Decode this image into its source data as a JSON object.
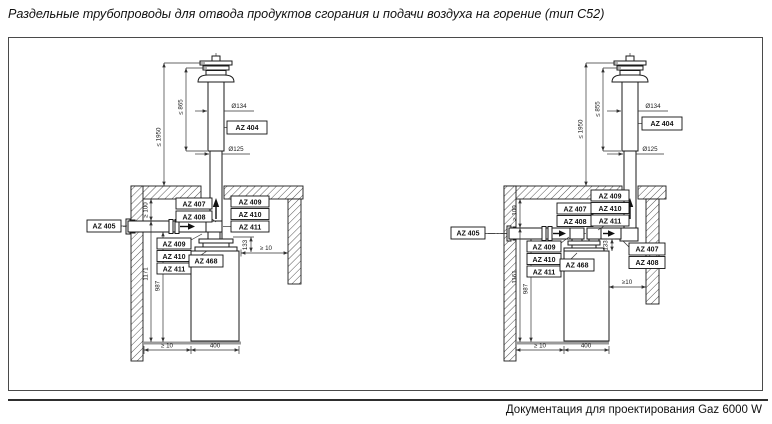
{
  "page": {
    "title": "Раздельные трубопроводы для отвода продуктов сгорания и подачи воздуха на горение (тип C52)",
    "footer": "Документация для проектирования Gaz 6000 W"
  },
  "colors": {
    "line": "#1a1a1a",
    "dim_line": "#333333",
    "floor_shadow": "#9a9a9a"
  },
  "diagram_left": {
    "dim_total_height": "≤ 1950",
    "dim_upper_section": "≤ 865",
    "dim_outer_diameter": "Ø134",
    "dim_inner_diameter": "Ø125",
    "dim_ceiling_clearance": "≥ 100",
    "dim_height_upper": "1171",
    "dim_height_lower": "987",
    "dim_adapter_height": "133",
    "dim_side_clearance": "≥ 10",
    "dim_floor_side_clearance": "≥ 10",
    "dim_boiler_width": "400",
    "label_roof_terminal": "AZ 404",
    "label_wall_duct": "AZ 405",
    "labels_flue_stack": [
      "AZ 407",
      "AZ 408"
    ],
    "labels_top_stack": [
      "AZ 409",
      "AZ 410",
      "AZ 411"
    ],
    "labels_side_stack": [
      "AZ 409",
      "AZ 410",
      "AZ 411"
    ],
    "label_adapter": "AZ 468"
  },
  "diagram_right": {
    "dim_total_height": "≤ 1950",
    "dim_upper_section": "≤ 855",
    "dim_outer_diameter": "Ø134",
    "dim_inner_diameter": "Ø125",
    "dim_ceiling_clearance": "≥ 100",
    "dim_height_upper": "1161",
    "dim_height_lower": "987",
    "dim_adapter_height": "133",
    "dim_side_clearance": "≥10",
    "dim_floor_side_clearance": "≥ 10",
    "dim_boiler_width": "400",
    "label_roof_terminal": "AZ 404",
    "label_wall_duct": "AZ 405",
    "labels_flue_stack": [
      "AZ 407",
      "AZ 408"
    ],
    "labels_top_stack": [
      "AZ 409",
      "AZ 410",
      "AZ 411"
    ],
    "labels_side_stack": [
      "AZ 409",
      "AZ 410",
      "AZ 411"
    ],
    "labels_right_stack": [
      "AZ 407",
      "AZ 408"
    ],
    "label_adapter": "AZ 468"
  }
}
